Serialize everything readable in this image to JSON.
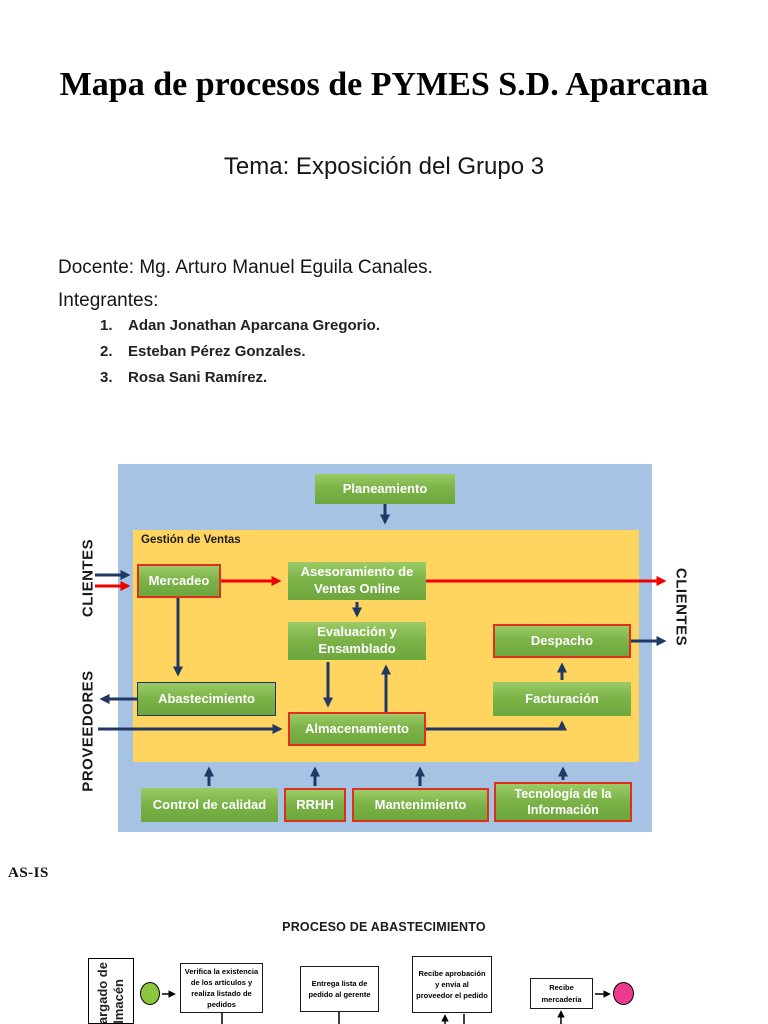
{
  "slide": {
    "title": "Mapa de procesos de PYMES S.D. Aparcana",
    "subtitle": "Tema: Exposición del Grupo 3",
    "docente": "Docente: Mg. Arturo Manuel Eguila Canales.",
    "integrantes_label": "Integrantes:",
    "members": [
      {
        "num": "1.",
        "name": "Adan Jonathan Aparcana Gregorio."
      },
      {
        "num": "2.",
        "name": "Esteban Pérez Gonzales."
      },
      {
        "num": "3.",
        "name": "Rosa Sani Ramírez."
      }
    ]
  },
  "process_map": {
    "inner_title": "Gestión de Ventas",
    "labels": {
      "left_top": "CLIENTES",
      "left_bottom": "PROVEEDORES",
      "right": "CLIENTES"
    },
    "boxes": {
      "planeamiento": "Planeamiento",
      "mercadeo": "Mercadeo",
      "asesoramiento": "Asesoramiento de Ventas Online",
      "evaluacion": "Evaluación y Ensamblado",
      "despacho": "Despacho",
      "abastecimiento": "Abastecimiento",
      "facturacion": "Facturación",
      "almacenamiento": "Almacenamiento",
      "control_calidad": "Control de calidad",
      "rrhh": "RRHH",
      "mantenimiento": "Mantenimiento",
      "tecnologia": "Tecnología de la Información"
    },
    "colors": {
      "outer_bg": "#A6C3E4",
      "inner_bg": "#FFD45F",
      "box_green": "#7DB44A",
      "red_border": "#E02F1F",
      "navy_arrow": "#1F3864",
      "red_arrow": "#F20000"
    }
  },
  "as_is": {
    "label": "AS-IS",
    "flow_title": "PROCESO DE ABASTECIMIENTO",
    "lane_label": "Encargado de almacén",
    "steps": [
      "Verifica la existencia de los artículos y realiza listado de pedidos",
      "Entrega lista de pedido al gerente",
      "Recibe aprobación y envía al proveedor el pedido",
      "Recibe mercadería"
    ],
    "colors": {
      "start_event": "#8CC63E",
      "end_event": "#EE3A8C"
    }
  }
}
